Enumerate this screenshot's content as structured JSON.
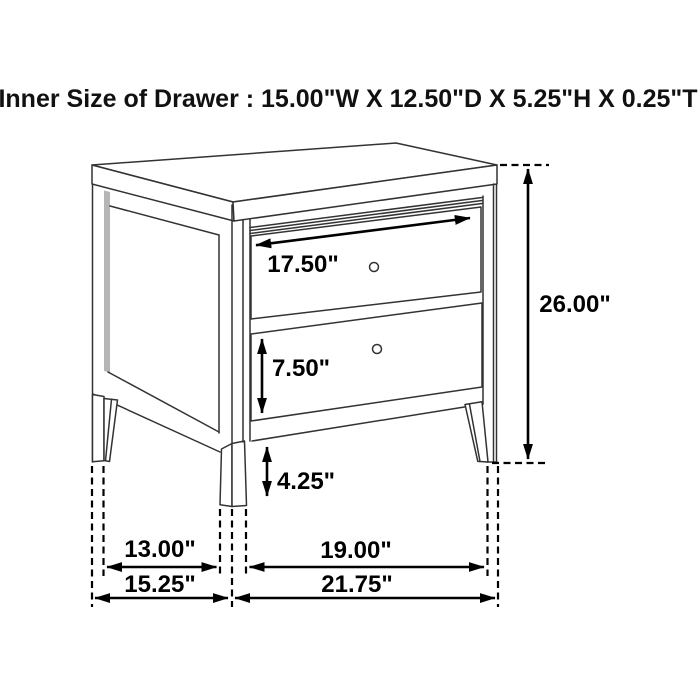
{
  "title": "Inner Size of Drawer : 15.00\"W X 12.50\"D X 5.25\"H X 0.25\"T",
  "figure": {
    "item": "two-drawer nightstand dimension line drawing",
    "annotations": {
      "drawer_opening_width": "17.50\"",
      "overall_height": "26.00\"",
      "lower_drawer_height": "7.50\"",
      "leg_height": "4.25\"",
      "side_legs_inner_span": "13.00\"",
      "side_outer_depth": "15.25\"",
      "front_legs_inner_span": "19.00\"",
      "front_outer_width": "21.75\""
    },
    "inner_drawer_size": {
      "width": "15.00\"",
      "depth": "12.50\"",
      "height": "5.25\"",
      "thickness": "0.25\""
    }
  },
  "colors": {
    "background": "#ffffff",
    "line": "#333333",
    "dimension": "#000000",
    "text": "#111111",
    "shade": "#b5b5b5"
  }
}
